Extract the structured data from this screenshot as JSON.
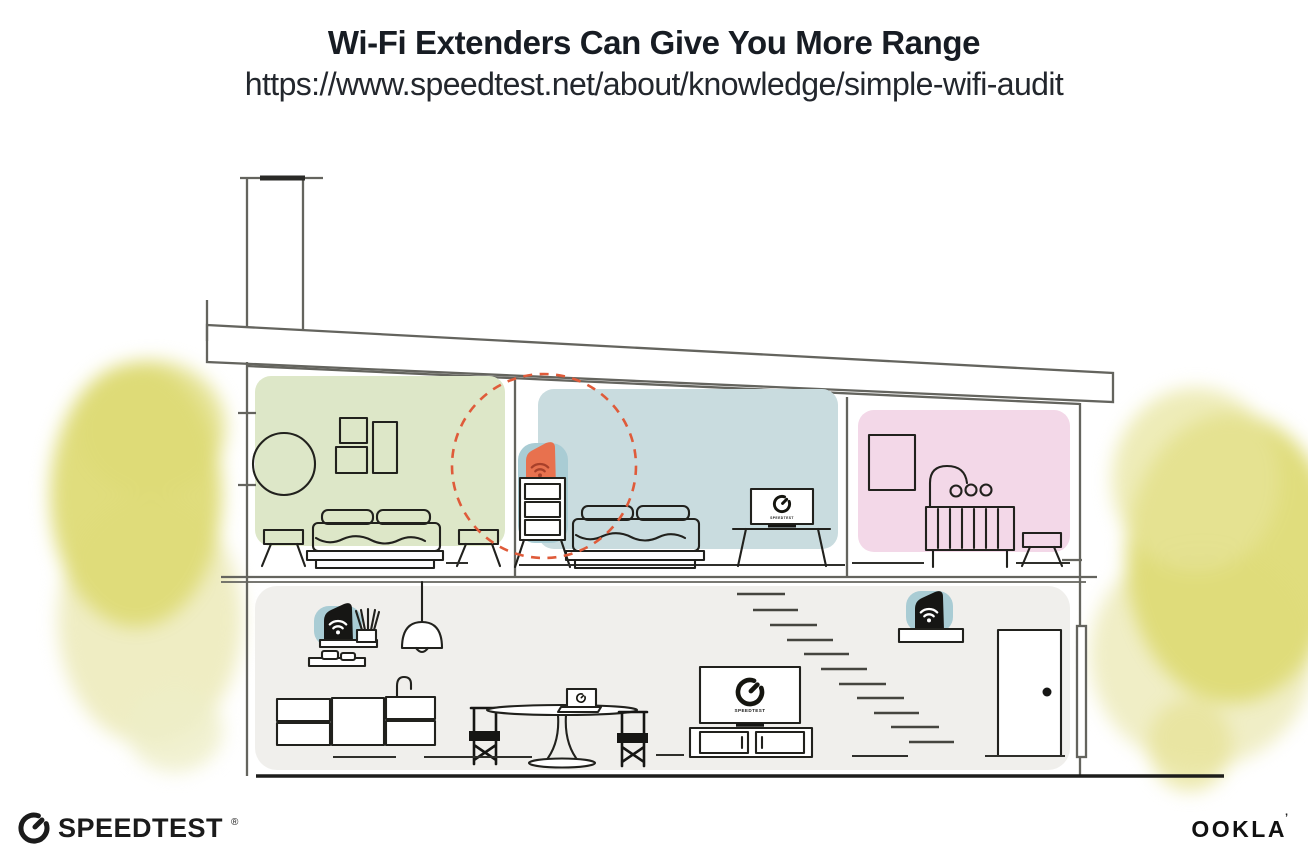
{
  "header": {
    "title": "Wi-Fi Extenders Can Give You More Range",
    "url": "https://www.speedtest.net/about/knowledge/simple-wifi-audit"
  },
  "illustration": {
    "tv_screen_label": "SPEEDTEST",
    "icons": {
      "wifi_extender": "wifi-icon",
      "speedtest_gauge": "speedtest-gauge-icon"
    }
  },
  "colors": {
    "room_green": "#dde7c8",
    "room_blue": "#c9dcdf",
    "room_pink": "#f3d8e8",
    "floor_gray": "#f0efec",
    "extender_teal": "#a9ccd4",
    "accent_orange": "#e8714e",
    "accent_orange_dark": "#a8402a",
    "range_circle": "#df5b3a",
    "foliage_yellow": "#dedb76",
    "foliage_yellow_light": "#eceab8",
    "line_gray": "#64645e",
    "line_dark": "#1d1d1b",
    "text_dark": "#171c23"
  },
  "footer": {
    "speedtest_logo_text": "SPEEDTEST",
    "speedtest_trademark": "®",
    "ookla_logo_text": "OOKLA",
    "ookla_trademark": "’"
  }
}
